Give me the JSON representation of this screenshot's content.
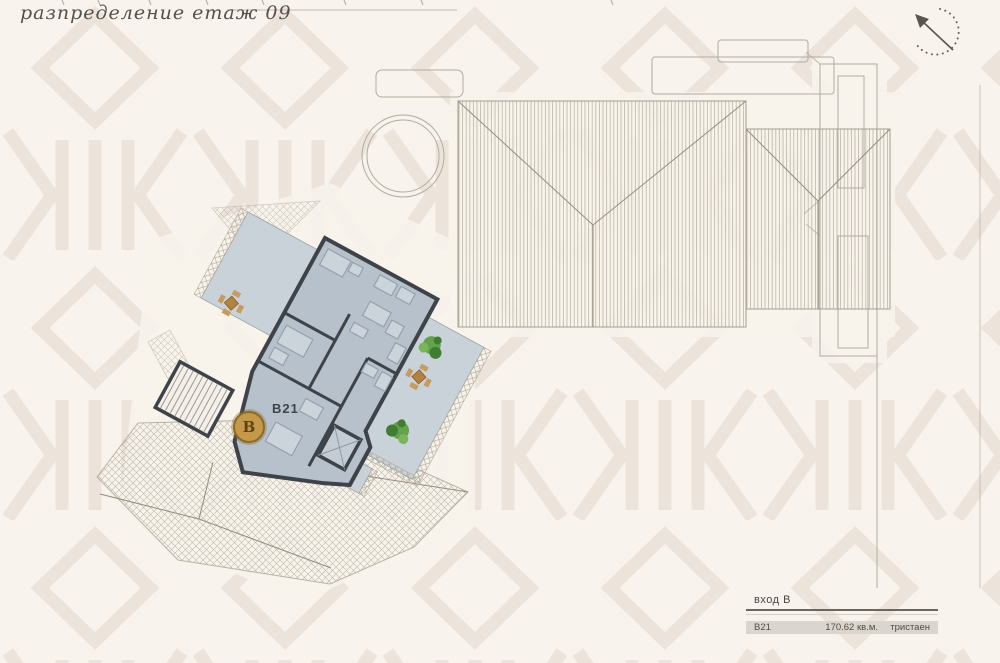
{
  "title": "разпределение етаж 09",
  "plan": {
    "unit_label": "В21",
    "entrance_marker": "В"
  },
  "legend": {
    "entrance_heading": "вход В",
    "rows": [
      {
        "id": "В21",
        "area": "170.62 кв.м.",
        "type": "тристаен"
      }
    ]
  },
  "compass": {
    "icon": "north-arrow"
  },
  "colors": {
    "background": "#f8f3ec",
    "pattern": "#ece4da",
    "apartment_fill": "#b6c1cb",
    "terrace_fill": "#c9d2d9",
    "wall": "#3e434a",
    "roof_line": "#a49e8e",
    "marker_gold": "#c49a4a",
    "tree_green": "#64a14b",
    "table_brown": "#b5813f",
    "legend_row_bg": "#dad5cd",
    "text": "#514d46"
  }
}
